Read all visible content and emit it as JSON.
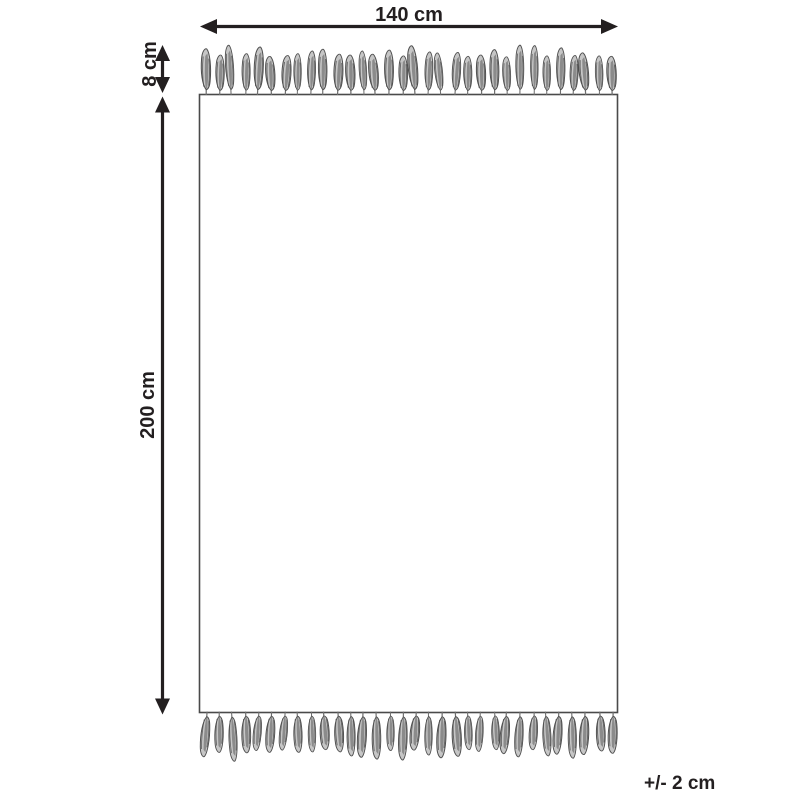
{
  "labels": {
    "width": "140 cm",
    "fringe_height": "8 cm",
    "length": "200 cm",
    "tolerance": "+/- 2 cm"
  },
  "colors": {
    "line": "#231f20",
    "rug_outline": "#4a4a4a",
    "tassel_fill": "#c6c6c6",
    "tassel_dark": "#4f4f4f",
    "background": "#ffffff"
  }
}
